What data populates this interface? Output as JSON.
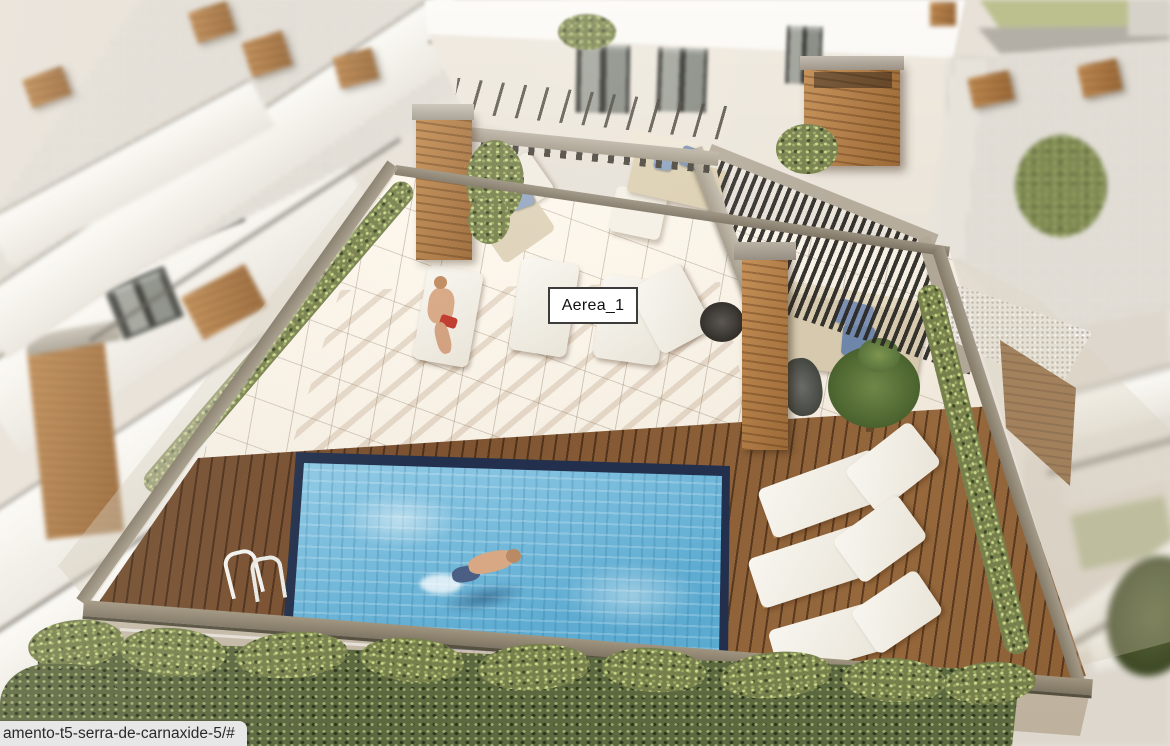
{
  "browser": {
    "status_url": "amento-t5-serra-de-carnaxide-5/#"
  },
  "viewer": {
    "hotspot_label": "Aerea_1"
  },
  "palette": {
    "pool_water": "#6db7da",
    "pool_rim": "#22304d",
    "deck_wood": "#7b5130",
    "wood_planter": "#b07c46",
    "tile_floor": "#f3ecdf",
    "rail_taupe": "#968c7a",
    "hedge_green": "#77804d",
    "lawn_green": "#bcc08f",
    "pergola_slat": "#2e2c29",
    "beam_gray": "#b3aa9b",
    "sofa_beige": "#d6c9ae",
    "cushion_blue": "#7b90b2",
    "lounger_white": "#f4f1ea",
    "facade_white": "#ece6dc",
    "window_dark": "#35352f",
    "skin_tone": "#d8a885",
    "swimsuit_red": "#c13a2e",
    "label_bg": "#ffffff",
    "label_border": "#3c3c3c",
    "label_text": "#111111",
    "statusbar_bg": "#e8e7e7",
    "statusbar_text": "#2a2a2a"
  }
}
